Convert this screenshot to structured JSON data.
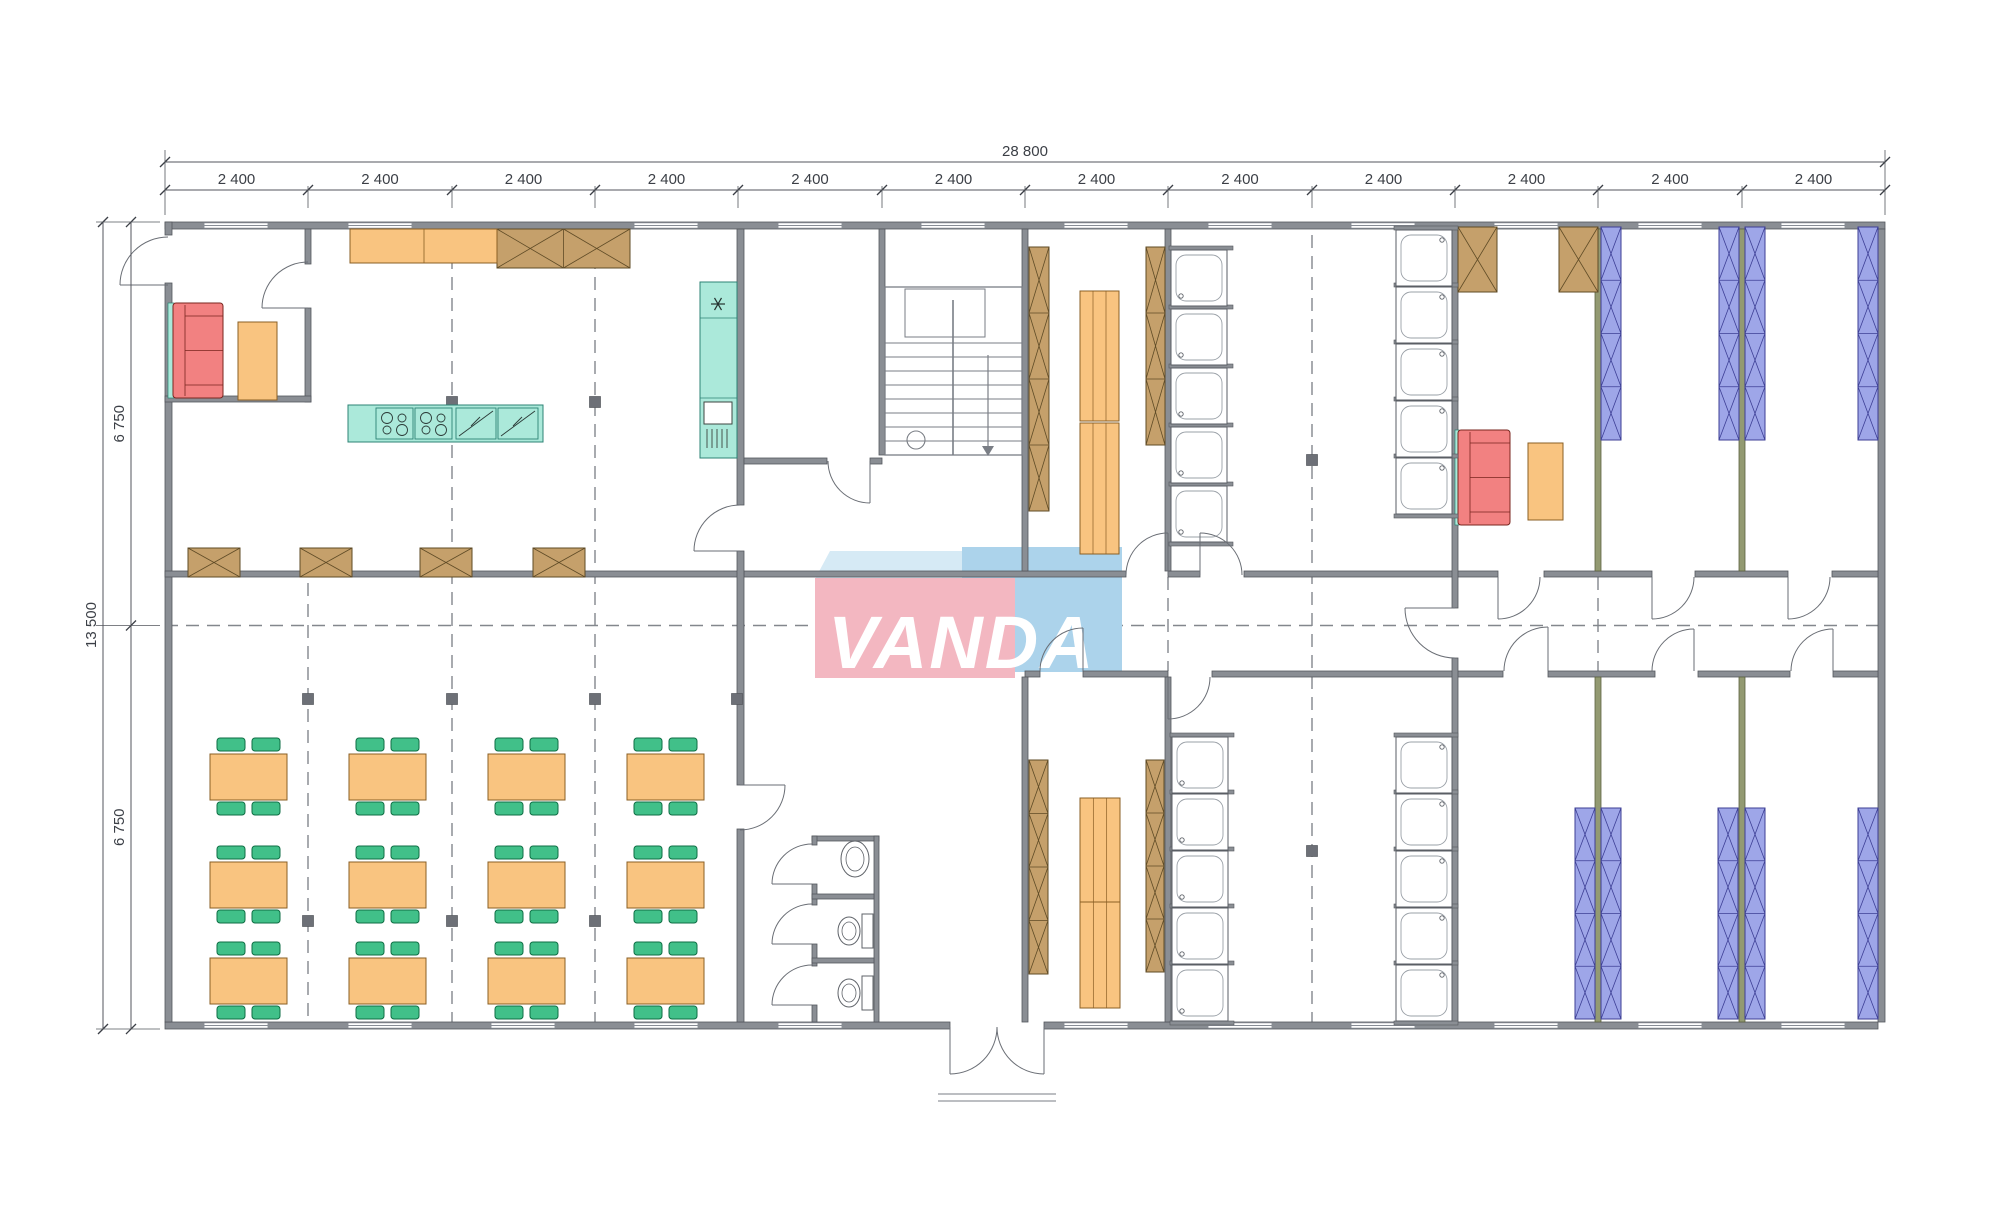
{
  "watermark": {
    "text": "VANDA",
    "colors": {
      "pink": "#f3b7c1",
      "blue": "#acd3eb",
      "top": "#d6eaf5"
    },
    "pink_rect": [
      815,
      578,
      200,
      100
    ],
    "blue_rect": [
      962,
      547,
      160,
      125
    ],
    "top_face": [
      [
        830,
        551
      ],
      [
        978,
        551
      ],
      [
        962,
        579
      ],
      [
        815,
        579
      ]
    ],
    "text_pos": [
      828,
      668
    ],
    "font_size": 74
  },
  "dimensions": {
    "top_total": {
      "label": "28 800",
      "y": 162,
      "x1": 165,
      "x2": 1885,
      "lx": 1025,
      "ly": 156
    },
    "top_segments": {
      "labels": [
        "2 400",
        "2 400",
        "2 400",
        "2 400",
        "2 400",
        "2 400",
        "2 400",
        "2 400",
        "2 400",
        "2 400",
        "2 400",
        "2 400"
      ],
      "y": 190,
      "ly": 184,
      "bounds": [
        165,
        308,
        452,
        595,
        738,
        882,
        1025,
        1168,
        1312,
        1455,
        1598,
        1742,
        1885
      ]
    },
    "left_total": {
      "label": "13 500",
      "x": 103,
      "y1": 222,
      "y2": 1029,
      "lx": 96,
      "ly": 625
    },
    "left_segments": {
      "labels": [
        "6 750",
        "6 750"
      ],
      "x": 131,
      "lx": 124,
      "bounds": [
        222,
        625.5,
        1029
      ]
    }
  },
  "palette": {
    "wall": "#8a8e94",
    "wall_edge": "#54575d",
    "olive": "#939a72",
    "olive_edge": "#5c6140",
    "window_line": "#888d95",
    "dash": "#83878d",
    "column": "#6d7077",
    "door": "#6a6e75",
    "orange": "#f9c480",
    "orange_edge": "#8a5f24",
    "brown": "#c5a06b",
    "brown_edge": "#5f4b26",
    "green": "#41c089",
    "green_edge": "#0e6e44",
    "blue": "#9ea6e8",
    "blue_edge": "#3d3f95",
    "red": "#f28181",
    "red_edge": "#79261f",
    "teal": "#abe9da",
    "teal_edge": "#2c8374",
    "fixture": "#5f6369",
    "stair": "#7a7e85",
    "dim_line": "#53565c"
  },
  "plan": {
    "walls_gray": [
      [
        165,
        222,
        1720,
        7
      ],
      [
        165,
        1022,
        785,
        7
      ],
      [
        1044,
        1022,
        834,
        7
      ],
      [
        165,
        222,
        7,
        13
      ],
      [
        165,
        283,
        7,
        739
      ],
      [
        1878,
        229,
        7,
        793
      ],
      [
        305,
        229,
        6,
        35
      ],
      [
        305,
        308,
        6,
        94
      ],
      [
        165,
        396,
        146,
        6
      ],
      [
        165,
        571,
        573,
        6
      ],
      [
        744,
        571,
        382,
        6
      ],
      [
        1168,
        571,
        32,
        6
      ],
      [
        1244,
        571,
        254,
        6
      ],
      [
        1544,
        571,
        108,
        6
      ],
      [
        1695,
        571,
        93,
        6
      ],
      [
        1832,
        571,
        46,
        6
      ],
      [
        1025,
        671,
        15,
        6
      ],
      [
        1083,
        671,
        85,
        6
      ],
      [
        1212,
        671,
        291,
        6
      ],
      [
        1548,
        671,
        107,
        6
      ],
      [
        1698,
        671,
        92,
        6
      ],
      [
        1833,
        671,
        45,
        6
      ],
      [
        737,
        229,
        7,
        276
      ],
      [
        737,
        551,
        7,
        234
      ],
      [
        737,
        829,
        7,
        193
      ],
      [
        879,
        229,
        6,
        226
      ],
      [
        1022,
        229,
        6,
        342
      ],
      [
        1022,
        677,
        6,
        345
      ],
      [
        1165,
        229,
        6,
        342
      ],
      [
        1165,
        677,
        6,
        345
      ],
      [
        1452,
        229,
        6,
        379
      ],
      [
        1452,
        658,
        6,
        364
      ],
      [
        744,
        458,
        83,
        6
      ],
      [
        870,
        458,
        12,
        6
      ],
      [
        812,
        836,
        67,
        5
      ],
      [
        874,
        836,
        5,
        186
      ],
      [
        812,
        836,
        5,
        9
      ],
      [
        812,
        884,
        5,
        21
      ],
      [
        812,
        944,
        5,
        22
      ],
      [
        812,
        1005,
        5,
        17
      ],
      [
        812,
        894,
        62,
        5
      ],
      [
        812,
        958,
        62,
        5
      ]
    ],
    "walls_olive": [
      [
        1595,
        229,
        6,
        342
      ],
      [
        1595,
        677,
        6,
        345
      ],
      [
        1739,
        229,
        6,
        342
      ],
      [
        1739,
        677,
        6,
        345
      ]
    ],
    "windows_top": {
      "y": 222.8,
      "w": 64,
      "h": 5.4,
      "xs": [
        204,
        348,
        634,
        778,
        921,
        1064,
        1208,
        1351,
        1494,
        1638,
        1781
      ]
    },
    "windows_bottom": {
      "y": 1022.8,
      "w": 64,
      "h": 5.4,
      "xs": [
        204,
        348,
        491,
        634,
        778,
        1064,
        1208,
        1351,
        1494,
        1638,
        1781
      ]
    },
    "dashed_v": [
      [
        308,
        583,
        1022
      ],
      [
        452,
        235,
        1022
      ],
      [
        595,
        235,
        1022
      ],
      [
        1312,
        235,
        1022
      ],
      [
        1168,
        577,
        671
      ],
      [
        1598,
        577,
        671
      ]
    ],
    "dashed_h": [
      [
        625.5,
        165,
        1885
      ]
    ],
    "columns": [
      [
        452,
        402
      ],
      [
        595,
        402
      ],
      [
        308,
        699
      ],
      [
        452,
        699
      ],
      [
        595,
        699
      ],
      [
        737,
        699
      ],
      [
        308,
        921
      ],
      [
        452,
        921
      ],
      [
        595,
        921
      ],
      [
        1312,
        460
      ],
      [
        1312,
        851
      ]
    ],
    "doors": [
      [
        168,
        285,
        48,
        180,
        270
      ],
      [
        308,
        308,
        46,
        180,
        270
      ],
      [
        740,
        551,
        46,
        180,
        270
      ],
      [
        870,
        461,
        42,
        90,
        180
      ],
      [
        740,
        785,
        45,
        0,
        90
      ],
      [
        1168,
        575,
        42,
        270,
        180
      ],
      [
        1200,
        575,
        42,
        270,
        360
      ],
      [
        1498,
        577,
        42,
        90,
        0
      ],
      [
        1652,
        577,
        42,
        90,
        0
      ],
      [
        1788,
        577,
        42,
        90,
        0
      ],
      [
        1083,
        671,
        43,
        270,
        180
      ],
      [
        1168,
        677,
        42,
        90,
        0
      ],
      [
        1548,
        671,
        44,
        270,
        180
      ],
      [
        1694,
        671,
        42,
        270,
        180
      ],
      [
        1833,
        671,
        42,
        270,
        180
      ],
      [
        1455,
        608,
        50,
        180,
        90
      ],
      [
        812,
        884,
        40,
        180,
        270
      ],
      [
        812,
        944,
        40,
        180,
        270
      ],
      [
        812,
        1005,
        40,
        180,
        270
      ],
      [
        950,
        1027,
        47,
        90,
        0
      ],
      [
        1044,
        1027,
        47,
        90,
        180
      ]
    ],
    "wardrobes_brown": [
      [
        497,
        229,
        133,
        39,
        2
      ],
      [
        188,
        548,
        52,
        29,
        1
      ],
      [
        300,
        548,
        52,
        29,
        1
      ],
      [
        420,
        548,
        52,
        29,
        1
      ],
      [
        533,
        548,
        52,
        29,
        1
      ],
      [
        1458,
        227,
        39,
        65,
        1
      ],
      [
        1559,
        227,
        39,
        65,
        1
      ],
      [
        1029,
        247,
        20,
        264,
        4
      ],
      [
        1146,
        247,
        19,
        198,
        3
      ],
      [
        1029,
        760,
        19,
        214,
        4
      ],
      [
        1146,
        760,
        18,
        212,
        4
      ]
    ],
    "bunks_blue": [
      [
        1601,
        227,
        20,
        213,
        4
      ],
      [
        1719,
        227,
        20,
        213,
        4
      ],
      [
        1745,
        227,
        20,
        213,
        4
      ],
      [
        1858,
        227,
        20,
        213,
        4
      ],
      [
        1575,
        808,
        20,
        211,
        4
      ],
      [
        1601,
        808,
        20,
        211,
        4
      ],
      [
        1718,
        808,
        20,
        211,
        4
      ],
      [
        1745,
        808,
        20,
        211,
        4
      ],
      [
        1858,
        808,
        20,
        211,
        4
      ]
    ],
    "cabinet": {
      "rect": [
        350,
        229,
        147,
        34
      ],
      "divider_x": 424
    },
    "small_tables": [
      [
        238,
        322,
        39,
        78
      ],
      [
        1528,
        443,
        35,
        77
      ]
    ],
    "benches": [
      [
        1080,
        291,
        39,
        130
      ],
      [
        1080,
        423,
        39,
        131
      ],
      [
        1080,
        798,
        40,
        104
      ],
      [
        1080,
        902,
        40,
        106
      ]
    ],
    "dining_tables": {
      "w": 77,
      "h": 46,
      "positions": [
        [
          210,
          754
        ],
        [
          349,
          754
        ],
        [
          488,
          754
        ],
        [
          627,
          754
        ],
        [
          210,
          862
        ],
        [
          349,
          862
        ],
        [
          488,
          862
        ],
        [
          627,
          862
        ],
        [
          210,
          958
        ],
        [
          349,
          958
        ],
        [
          488,
          958
        ],
        [
          627,
          958
        ]
      ]
    },
    "sofas": [
      [
        173,
        303,
        50,
        95
      ],
      [
        1458,
        430,
        52,
        95
      ]
    ],
    "sofa_backs": [
      [
        168,
        303,
        6,
        95
      ],
      [
        1455,
        430,
        4,
        95
      ]
    ],
    "island": {
      "rect": [
        348,
        405,
        195,
        37
      ],
      "stoves": [
        [
          376,
          408
        ],
        [
          415,
          408
        ]
      ],
      "sw": 37,
      "sh": 31,
      "sinks": [
        [
          456,
          408
        ],
        [
          498,
          408
        ]
      ],
      "kw": 40,
      "kh": 31
    },
    "counter": {
      "rect": [
        700,
        282,
        37,
        176
      ],
      "div_ys": [
        318,
        398
      ],
      "star": [
        718,
        304
      ],
      "box": [
        704,
        402,
        28,
        22
      ],
      "grill": {
        "x0": 707,
        "dx": 5,
        "n": 5,
        "y1": 429,
        "y2": 448
      }
    },
    "showers": {
      "size": 56,
      "cols": [
        {
          "x": 1171,
          "ys": [
            250,
            309,
            368,
            427,
            486
          ],
          "side": "l"
        },
        {
          "x": 1396,
          "ys": [
            230,
            287,
            344,
            401,
            458
          ],
          "side": "r"
        },
        {
          "x": 1172,
          "ys": [
            737,
            794,
            851,
            908,
            965
          ],
          "side": "l"
        },
        {
          "x": 1396,
          "ys": [
            737,
            794,
            851,
            908,
            965
          ],
          "side": "r"
        }
      ]
    },
    "wc": {
      "sink": [
        855,
        859
      ],
      "toilets": [
        [
          862,
          914
        ],
        [
          862,
          976
        ]
      ]
    },
    "stairs": {
      "box": [
        885,
        287,
        137,
        168
      ],
      "landing": [
        905,
        289,
        80,
        48
      ],
      "divider": [
        953,
        300,
        455
      ],
      "steps": {
        "x1": 885,
        "x2": 1022,
        "y0": 343,
        "dy": 14,
        "n": 9
      },
      "arrow": {
        "x": 988,
        "y1": 355,
        "y2": 446
      },
      "circle": [
        916,
        440,
        9
      ]
    },
    "porch": [
      [
        938,
        1094,
        1056,
        1094
      ],
      [
        938,
        1101,
        1056,
        1101
      ]
    ]
  }
}
